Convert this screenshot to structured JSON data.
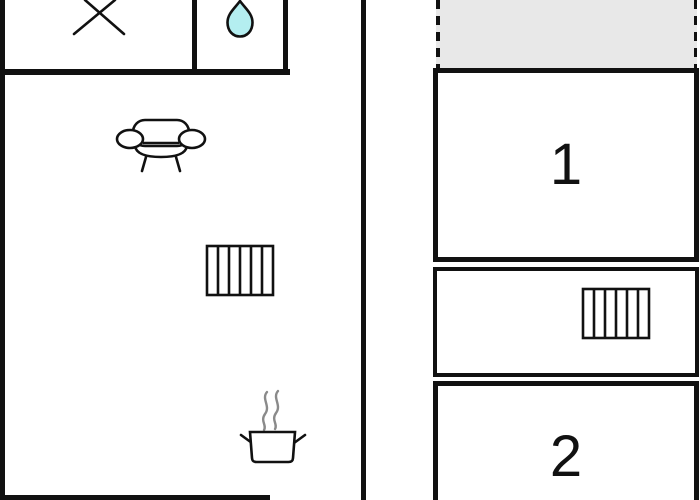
{
  "floorplan": {
    "left_unit": {
      "icons": [
        "cross-icon",
        "water-drop-icon",
        "sofa-icon",
        "radiator-icon",
        "stove-pot-icon",
        "steam-icon"
      ]
    },
    "right_unit": {
      "terrace": {
        "style": "dashed-outline-gray"
      },
      "rooms": [
        {
          "label": "1"
        },
        {
          "label": ""
        },
        {
          "label": "2"
        }
      ],
      "icons": [
        "radiator-icon"
      ]
    },
    "colors": {
      "wall": "#111111",
      "background": "#ffffff",
      "water_drop": "#b4eef0",
      "terrace": "#e8e8e8",
      "steam": "#8a8a8a"
    }
  }
}
